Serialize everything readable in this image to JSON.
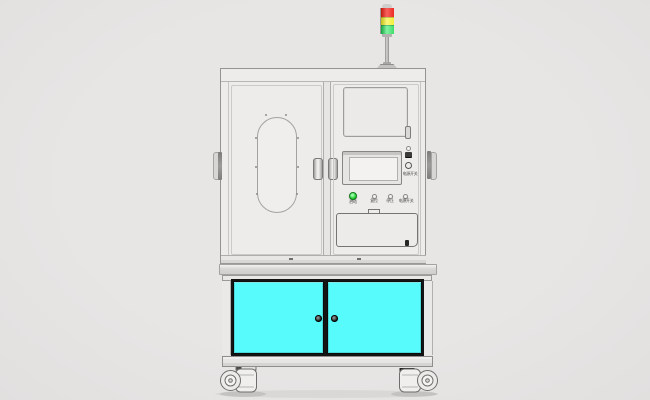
{
  "machine": {
    "description": "front view CAD render of an automation equipment cabinet on casters",
    "signal_tower": {
      "lamps": [
        "red",
        "yellow",
        "green"
      ]
    },
    "control_panel": {
      "power_switch_label": "电源开关",
      "buttons": [
        {
          "label": "启动",
          "type": "green-pushbutton"
        },
        {
          "label": "复位",
          "type": "small-pushbutton"
        },
        {
          "label": "停止",
          "type": "small-pushbutton"
        },
        {
          "label": "电源开关",
          "type": "small-pushbutton"
        }
      ]
    }
  },
  "colors": {
    "background": "#e8e6e5",
    "tower-red": "#ee2b26",
    "tower-yellow": "#f2ef3c",
    "tower-green": "#3fdd6b",
    "button-green": "#2bd93b",
    "door-cyan": "#58fbfb",
    "cabinet-face": "#edecea",
    "outline-gray": "#949392"
  }
}
